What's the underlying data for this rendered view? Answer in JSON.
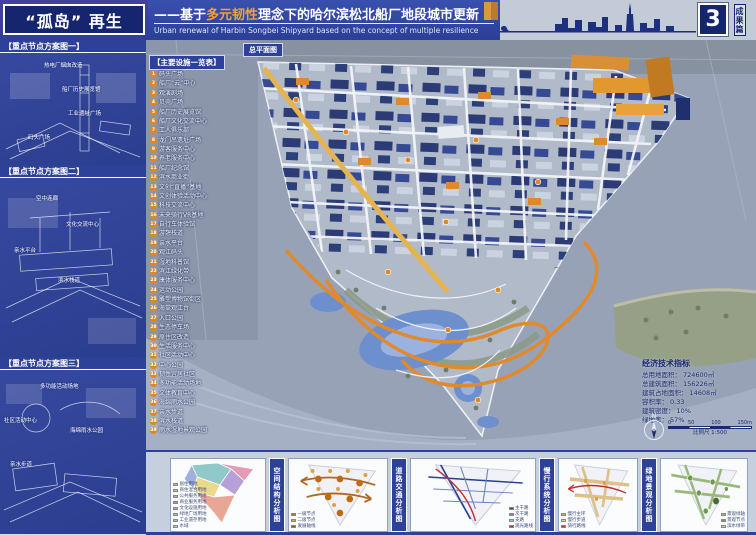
{
  "header": {
    "title": "“孤岛” 再生",
    "subtitle_prefix": "——基于",
    "subtitle_highlight": "多元韧性",
    "subtitle_suffix": "理念下的哈尔滨松北船厂地段城市更新",
    "subtitle_en": "Urban renewal of Harbin Songbei Shipyard based on the concept of multiple resilience",
    "page_number": "3",
    "page_tag": "成果篇"
  },
  "sidebar": {
    "panels": [
      {
        "label": "【重点节点方案图一】",
        "annotations": [
          "热电厂烟囱改造",
          "船厂历史展览馆",
          "工业遗址广场",
          "码头广场"
        ]
      },
      {
        "label": "【重点节点方案图二】",
        "annotations": [
          "空中连廊",
          "文化交流中心",
          "亲水平台",
          "滨水栈道"
        ]
      },
      {
        "label": "【重点节点方案图三】",
        "annotations": [
          "多功能活动场地",
          "社区活动中心",
          "海绵雨水公园",
          "亲水步道"
        ]
      }
    ]
  },
  "map": {
    "title_tag": "总平面图",
    "legend_title": "【主要设施一览表】",
    "legend_items": [
      {
        "num": "1",
        "label": "码头广场"
      },
      {
        "num": "2",
        "label": "船厂“云”中心"
      },
      {
        "num": "3",
        "label": "观演剧场"
      },
      {
        "num": "4",
        "label": "贝壳广场"
      },
      {
        "num": "5",
        "label": "船厂历史展览馆"
      },
      {
        "num": "6",
        "label": "船厂文化交流中心"
      },
      {
        "num": "7",
        "label": "工人俱乐部"
      },
      {
        "num": "8",
        "label": "龙门吊遗址广场"
      },
      {
        "num": "9",
        "label": "游客服务中心"
      },
      {
        "num": "10",
        "label": "养老服务中心"
      },
      {
        "num": "11",
        "label": "船厂纪念馆"
      },
      {
        "num": "12",
        "label": "滨水商业街"
      },
      {
        "num": "13",
        "label": "文创“直播”基地"
      },
      {
        "num": "14",
        "label": "文创体验活动中心"
      },
      {
        "num": "15",
        "label": "科技交流中心"
      },
      {
        "num": "16",
        "label": "未来骑行VR基地"
      },
      {
        "num": "17",
        "label": "自行车体验馆"
      },
      {
        "num": "18",
        "label": "游憩栈道"
      },
      {
        "num": "19",
        "label": "亲水平台"
      },
      {
        "num": "20",
        "label": "观江码头"
      },
      {
        "num": "21",
        "label": "湿地科普馆"
      },
      {
        "num": "22",
        "label": "滨江绿化带"
      },
      {
        "num": "23",
        "label": "康体服务中心"
      },
      {
        "num": "24",
        "label": "运动公园"
      },
      {
        "num": "25",
        "label": "雕塑博物馆街区"
      },
      {
        "num": "26",
        "label": "海棠观江台"
      },
      {
        "num": "27",
        "label": "入口公园"
      },
      {
        "num": "28",
        "label": "生态停车场"
      },
      {
        "num": "29",
        "label": "原住区改造"
      },
      {
        "num": "30",
        "label": "生活服务中心"
      },
      {
        "num": "31",
        "label": "社区活动中心"
      },
      {
        "num": "32",
        "label": "中心公园"
      },
      {
        "num": "33",
        "label": "韧性宜居社区"
      },
      {
        "num": "34",
        "label": "多功能活动场地"
      },
      {
        "num": "35",
        "label": "文体教育中心"
      },
      {
        "num": "36",
        "label": "海绵雨水公园"
      },
      {
        "num": "37",
        "label": "亲水步道"
      },
      {
        "num": "38",
        "label": "滨水栈道"
      },
      {
        "num": "39",
        "label": "雨水湿地景观公园"
      }
    ],
    "indicators": {
      "title": "经济技术指标",
      "rows": [
        {
          "label": "总用地面积：",
          "value": "724600㎡"
        },
        {
          "label": "总建筑面积：",
          "value": "156226㎡"
        },
        {
          "label": "建筑占地面积：",
          "value": "14608㎡"
        },
        {
          "label": "容积率：",
          "value": "0.33"
        },
        {
          "label": "建筑密度：",
          "value": "10%"
        },
        {
          "label": "绿地率：",
          "value": "57%"
        }
      ]
    },
    "north_label": "N",
    "scale": {
      "ticks": [
        "0",
        "50",
        "100",
        "150m"
      ],
      "caption": "比例尺 1:500"
    }
  },
  "bottom": {
    "strips": [
      "空间结构分析图",
      "道路交通分析图",
      "慢行系统分析图",
      "绿地景观分析图"
    ],
    "cards": [
      {
        "legend": [
          {
            "color": "#e39cb4",
            "label": "居住用地"
          },
          {
            "color": "#e8a795",
            "label": "商住混合用地"
          },
          {
            "color": "#9fb0dd",
            "label": "公共服务用地"
          },
          {
            "color": "#e07a7a",
            "label": "商业服务用地"
          },
          {
            "color": "#b79fd8",
            "label": "文化设施用地"
          },
          {
            "color": "#9cc99c",
            "label": "绿地广场用地"
          },
          {
            "color": "#8fc9c9",
            "label": "工业遗存用地"
          },
          {
            "color": "#a8c8e8",
            "label": "水域"
          }
        ]
      },
      {
        "legend": [
          {
            "color": "#b06a18",
            "label": "一级节点"
          },
          {
            "color": "#e0a040",
            "label": "二级节点"
          },
          {
            "color": "#8a5a20",
            "label": "发展轴线"
          }
        ]
      },
      {
        "legend": [
          {
            "color": "#27408f",
            "label": "主干路"
          },
          {
            "color": "#6a82c0",
            "label": "次干路"
          },
          {
            "color": "#aab8dc",
            "label": "支路"
          },
          {
            "color": "#c03030",
            "label": "观光路线"
          }
        ]
      },
      {
        "legend": [
          {
            "color": "#d8a84e",
            "label": "慢行主环"
          },
          {
            "color": "#e8cf96",
            "label": "慢行步道"
          },
          {
            "color": "#c03030",
            "label": "骑行路线"
          }
        ]
      },
      {
        "legend": [
          {
            "color": "#9ab87a",
            "label": "景观绿轴"
          },
          {
            "color": "#6f9a50",
            "label": "景观节点"
          },
          {
            "color": "#b8d0a0",
            "label": "滨水绿带"
          }
        ]
      }
    ]
  },
  "colors": {
    "board_blue": "#2e4198",
    "navy": "#16266e",
    "accent_orange": "#e2861f",
    "highlight_orange": "#f0a13a"
  }
}
